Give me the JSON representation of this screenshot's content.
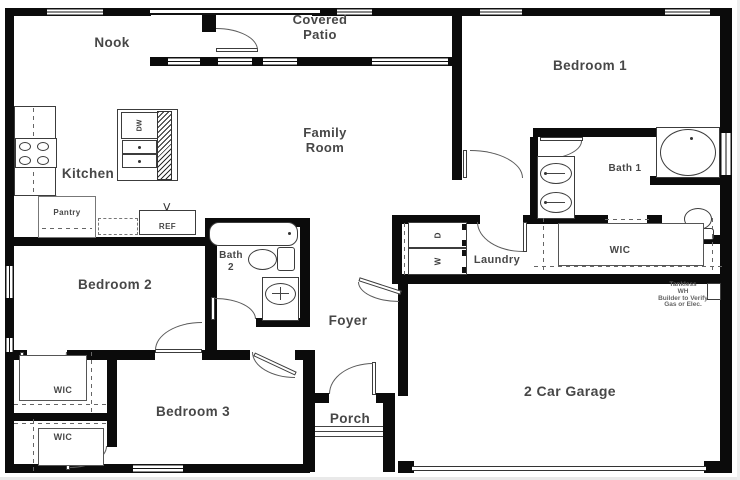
{
  "plan": {
    "rooms": {
      "nook": "Nook",
      "covered_patio": [
        "Covered",
        "Patio"
      ],
      "bedroom1": "Bedroom 1",
      "family_room": [
        "Family",
        "Room"
      ],
      "kitchen": "Kitchen",
      "pantry": "Pantry",
      "bath1": "Bath 1",
      "bath2": [
        "Bath",
        "2"
      ],
      "bedroom2": "Bedroom 2",
      "laundry": "Laundry",
      "wic_master": "WIC",
      "foyer": "Foyer",
      "bedroom3": "Bedroom 3",
      "wic_bedroom2": "WIC",
      "wic_bedroom3": "WIC",
      "porch": "Porch",
      "garage": "2 Car Garage"
    },
    "appliances": {
      "refrigerator": "REF",
      "dishwasher": "DW",
      "washer": "W",
      "dryer": "D"
    },
    "water_heater_note": [
      "Tankless",
      "WH",
      "Builder to Verify",
      "Gas or Elec."
    ],
    "colors": {
      "wall": "#0b0b0b",
      "label": "#474747",
      "note": "#666666"
    }
  }
}
